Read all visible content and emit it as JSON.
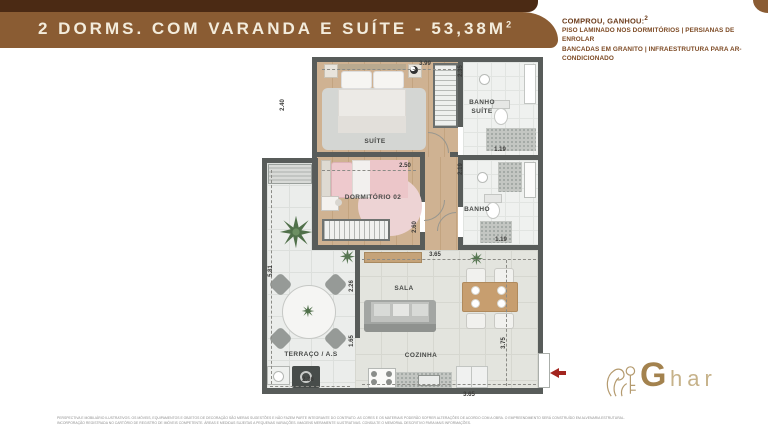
{
  "header": {
    "title": "2 DORMS. COM VARANDA E SUÍTE - 53,38M",
    "title_superscript": "2",
    "bar_color": "#4b2a14",
    "banner_color": "#8a5c33",
    "promo": {
      "heading": "COMPROU, GANHOU:",
      "heading_superscript": "2",
      "line1": "PISO LAMINADO NOS DORMITÓRIOS | PERSIANAS DE ENROLAR",
      "line2": "BANCADAS EM GRANITO | INFRAESTRUTURA PARA AR-CONDICIONADO"
    }
  },
  "floorplan": {
    "labels": {
      "suite": "SUÍTE",
      "banho_suite": "BANHO SUÍTE",
      "dormitorio": "DORMITÓRIO 02",
      "banho": "BANHO",
      "sala": "SALA",
      "cozinha": "COZINHA",
      "terraco": "TERRAÇO / A.S"
    },
    "dims": {
      "suite_top": "3.99",
      "suite_left": "2.40",
      "banho_suite_left": "2.35",
      "banho_suite_bottom": "1.19",
      "dorm_top": "2.50",
      "dorm_right": "2.60",
      "banho_left": "2.19",
      "banho_bottom": "1.19",
      "sala_top": "3.65",
      "sala_left": "2.26",
      "cozinha_left": "1.65",
      "cozinha_right": "3.75",
      "cozinha_bottom": "3.65",
      "terraco_left": "5.81",
      "terraco_bottom": "2.36"
    },
    "entrance_arrow_color": "#a3251f"
  },
  "logo": {
    "g": "G",
    "rest": "har"
  },
  "disclaimer": {
    "line1": "PERSPECTIVA E MOBILIÁRIO ILUSTRATIVOS. OS MÓVEIS, EQUIPAMENTOS E OBJETOS DE DECORAÇÃO SÃO MERAS SUGESTÕES E NÃO FAZEM PARTE INTEGRANTE DO CONTRATO. AS CORES E OS MATERIAIS PODERÃO SOFRER ALTERAÇÕES DE ACORDO COM A OBRA. O EMPREENDIMENTO SERÁ CONSTRUÍDO EM ALVENARIA ESTRUTURAL.",
    "line2": "INCORPORAÇÃO REGISTRADA NO CARTÓRIO DE REGISTRO DE IMÓVEIS COMPETENTE. ÁREAS E MEDIDAS SUJEITAS A PEQUENAS VARIAÇÕES. IMAGENS MERAMENTE ILUSTRATIVAS. CONSULTE O MEMORIAL DESCRITIVO PARA MAIS INFORMAÇÕES."
  }
}
